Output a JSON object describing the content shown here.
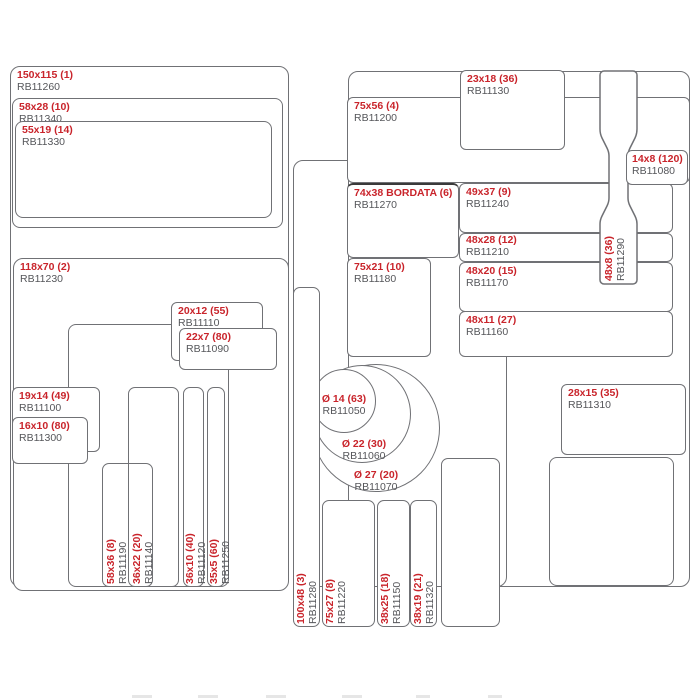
{
  "diagram": {
    "kind": "label-size-catalog-diagram",
    "accent_color": "#c9242b",
    "code_color": "#55565a",
    "line_color": "#707175"
  },
  "labels": {
    "rb11260": {
      "size": "150x115 (1)",
      "code": "RB11260"
    },
    "rb11340": {
      "size": "58x28 (10)",
      "code": "RB11340"
    },
    "rb11330": {
      "size": "55x19 (14)",
      "code": "RB11330"
    },
    "rb11230": {
      "size": "118x70 (2)",
      "code": "RB11230"
    },
    "rb11130": {
      "size": "23x18 (36)",
      "code": "RB11130"
    },
    "rb11200": {
      "size": "75x56 (4)",
      "code": "RB11200"
    },
    "rb11080": {
      "size": "14x8 (120)",
      "code": "RB11080"
    },
    "rb11270": {
      "size": "74x38 BORDATA (6)",
      "code": "RB11270"
    },
    "rb11240": {
      "size": "49x37 (9)",
      "code": "RB11240"
    },
    "rb11210": {
      "size": "48x28 (12)",
      "code": "RB11210"
    },
    "rb11180": {
      "size": "75x21 (10)",
      "code": "RB11180"
    },
    "rb11170": {
      "size": "48x20 (15)",
      "code": "RB11170"
    },
    "rb11160": {
      "size": "48x11 (27)",
      "code": "RB11160"
    },
    "rb11290": {
      "size": "48x8 (36)",
      "code": "RB11290"
    },
    "rb11110": {
      "size": "20x12 (55)",
      "code": "RB11110"
    },
    "rb11090": {
      "size": "22x7 (80)",
      "code": "RB11090"
    },
    "rb11100": {
      "size": "19x14 (49)",
      "code": "RB11100"
    },
    "rb11300": {
      "size": "16x10 (80)",
      "code": "RB11300"
    },
    "rb11050": {
      "size": "Ø 14 (63)",
      "code": "RB11050"
    },
    "rb11060": {
      "size": "Ø 22 (30)",
      "code": "RB11060"
    },
    "rb11070": {
      "size": "Ø 27 (20)",
      "code": "RB11070"
    },
    "rb11310": {
      "size": "28x15 (35)",
      "code": "RB11310"
    },
    "rb11190": {
      "size": "58x36 (8)",
      "code": "RB11190"
    },
    "rb11140": {
      "size": "36x22 (20)",
      "code": "RB11140"
    },
    "rb11120": {
      "size": "36x10 (40)",
      "code": "RB11120"
    },
    "rb11250": {
      "size": "35x5 (60)",
      "code": "RB11250"
    },
    "rb11280": {
      "size": "100x48 (3)",
      "code": "RB11280"
    },
    "rb11220": {
      "size": "75x27 (8)",
      "code": "RB11220"
    },
    "rb11150": {
      "size": "38x25 (18)",
      "code": "RB11150"
    },
    "rb11320": {
      "size": "38x19 (21)",
      "code": "RB11320"
    }
  }
}
